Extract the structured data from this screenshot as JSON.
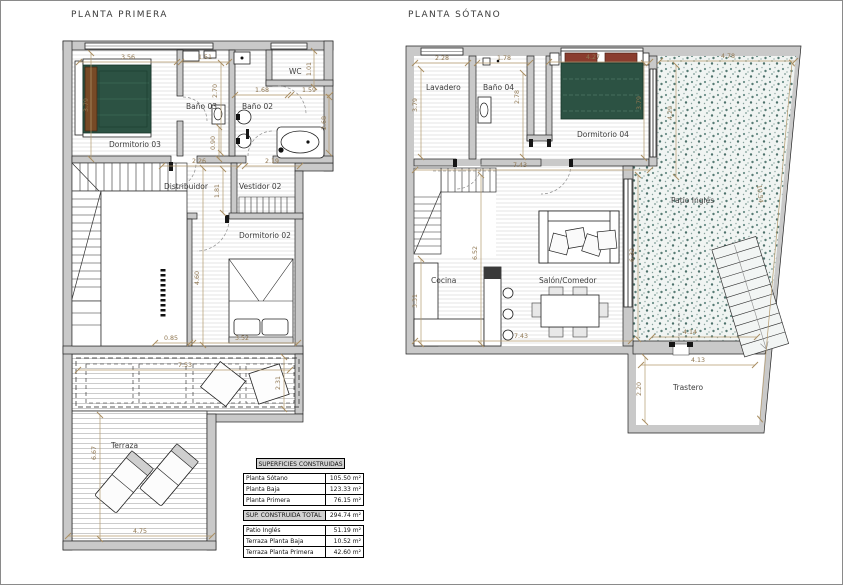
{
  "titles": {
    "left": "PLANTA PRIMERA",
    "right": "PLANTA SÓTANO"
  },
  "planta_primera": {
    "rooms": {
      "dormitorio03": "Dormitorio 03",
      "bano03": "Baño 03",
      "bano02": "Baño 02",
      "wc": "WC",
      "distribuidor": "Distribuidor",
      "vestidor02": "Vestidor 02",
      "dormitorio02": "Dormitorio 02",
      "terraza": "Terraza"
    },
    "dims": {
      "a356": "3.56",
      "a151": "1.51",
      "a101": "1.01",
      "a270": "2.70",
      "a168": "1.68",
      "a159": "1.59",
      "a268": "2.68",
      "a090": "0.90",
      "a226": "2.26",
      "a219": "2.19",
      "a181": "1.81",
      "a379": "3.79",
      "a460": "4.60",
      "a085": "0.85",
      "a352": "3.52",
      "a753": "7.53",
      "a231": "2.31",
      "a667": "6.67",
      "a475": "4.75"
    }
  },
  "planta_sotano": {
    "rooms": {
      "lavadero": "Lavadero",
      "bano04": "Baño 04",
      "dormitorio04": "Dormitorio 04",
      "patio": "Patio Inglés",
      "cocina": "Cocina",
      "salon": "Salón/Comedor",
      "trastero": "Trastero"
    },
    "dims": {
      "b228": "2.28",
      "b178": "1.78",
      "b427": "4.27",
      "b478": "4.78",
      "b379a": "3.79",
      "b278": "2.78",
      "b379b": "3.79",
      "b429": "4.29",
      "b743a": "7.43",
      "b652": "6.52",
      "b331": "3.31",
      "b632": "6.32",
      "b1054": "10.54",
      "b743b": "7.43",
      "b414": "4.14",
      "b413": "4.13",
      "b220": "2.20"
    }
  },
  "surface_table": {
    "header": "SUPERFICIES CONSTRUIDAS",
    "rows": [
      {
        "label": "Planta Sótano",
        "value": "105.50 m²"
      },
      {
        "label": "Planta Baja",
        "value": "123.33 m²"
      },
      {
        "label": "Planta Primera",
        "value": "76.15 m²"
      }
    ],
    "total": {
      "label": "SUP. CONSTRUIDA TOTAL",
      "value": "294.74 m²"
    },
    "extras": [
      {
        "label": "Patio Inglés",
        "value": "51.19 m²"
      },
      {
        "label": "Terraza Planta Baja",
        "value": "10.52 m²"
      },
      {
        "label": "Terraza Planta Primera",
        "value": "42.60 m²"
      }
    ]
  }
}
